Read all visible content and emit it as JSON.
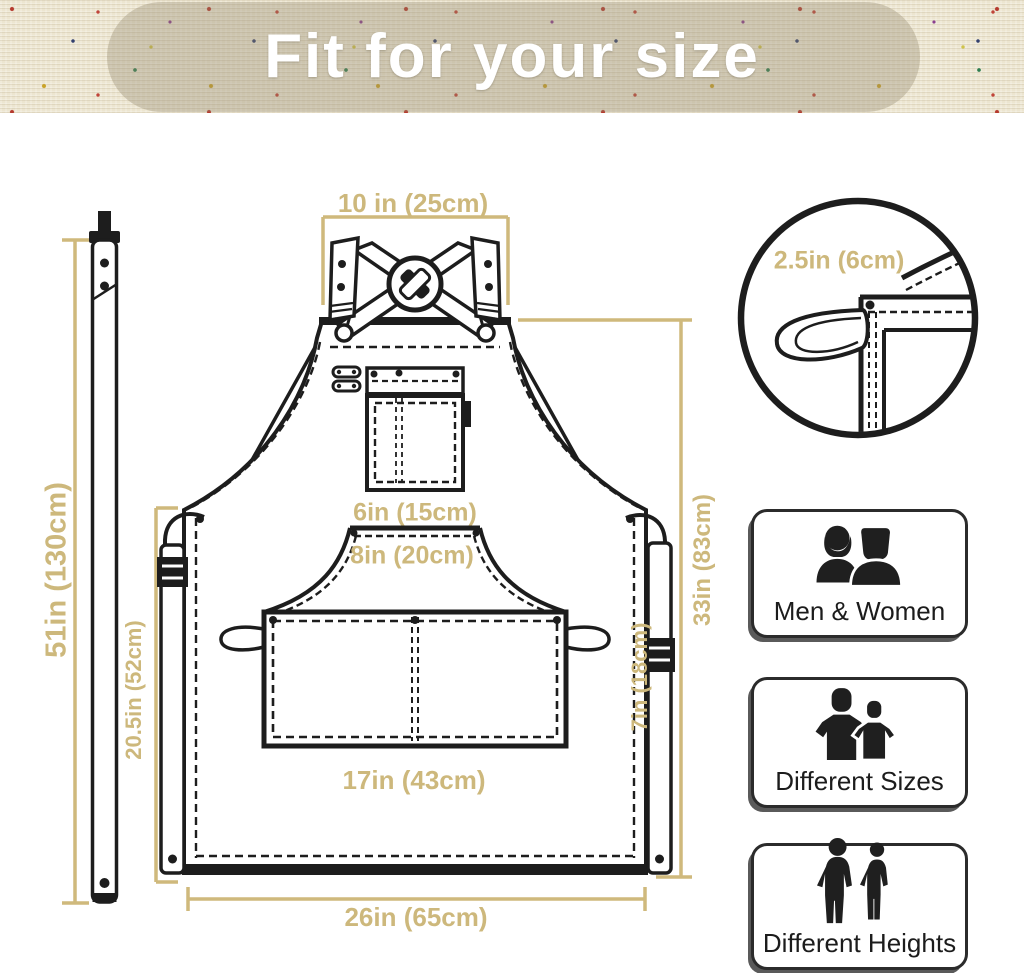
{
  "banner": {
    "title": "Fit for your size"
  },
  "measurements": {
    "top_width": "10 in (25cm)",
    "strap_length": "51in (130cm)",
    "body_height": "33in (83cm)",
    "skirt_height": "20.5in (52cm)",
    "chest_pocket_width": "6in (15cm)",
    "waist_panel_width": "8in (20cm)",
    "pocket_width": "17in (43cm)",
    "pocket_height": "7in (18cm)",
    "bottom_width": "26in (65cm)",
    "loop_width": "2.5in (6cm)"
  },
  "features": [
    {
      "icon": "men-women-icon",
      "label": "Men & Women"
    },
    {
      "icon": "different-sizes-icon",
      "label": "Different Sizes"
    },
    {
      "icon": "different-heights-icon",
      "label": "Different Heights"
    }
  ],
  "colors": {
    "measure_accent": "#cdb87c",
    "line_art": "#1d1d1d",
    "banner_background": "#ece5d0",
    "banner_text": "#ffffff"
  }
}
